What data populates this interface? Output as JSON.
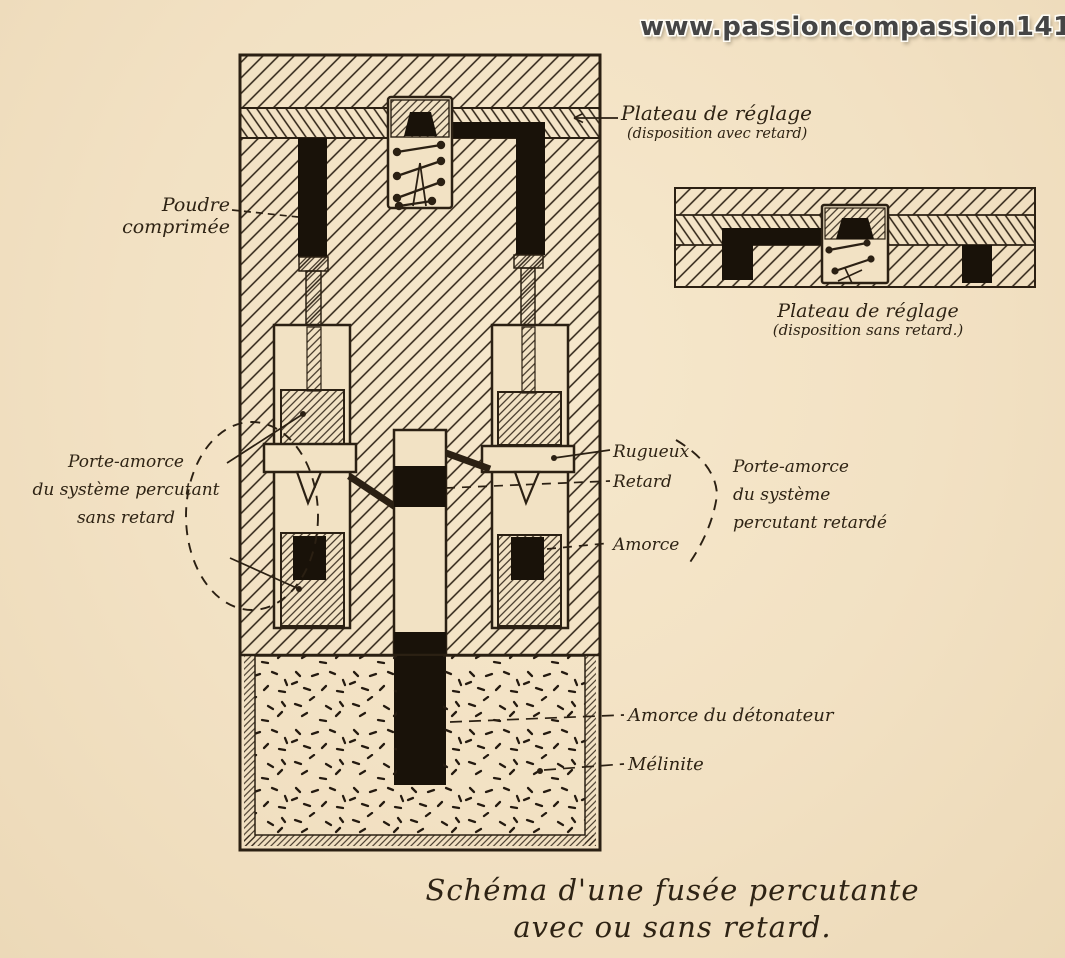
{
  "watermark": "www.passioncompassion1418.com",
  "colors": {
    "paper": "#f2e2c4",
    "ink": "#2b2013",
    "fill_black": "#191209",
    "watermark_text": "#454545"
  },
  "labels": {
    "plateau_avec": {
      "line1": "Plateau de réglage",
      "line2": "(disposition avec retard)"
    },
    "poudre": {
      "line1": "Poudre",
      "line2": "comprimée"
    },
    "porte_amorce_sans": {
      "line1": "Porte-amorce",
      "line2": "du système percutant",
      "line3": "sans retard"
    },
    "rugueux": "Rugueux",
    "retard": "Retard",
    "amorce": "Amorce",
    "porte_amorce_retarde": {
      "line1": "Porte-amorce",
      "line2": "du système",
      "line3": "percutant retardé"
    },
    "amorce_detonateur": "Amorce du détonateur",
    "melinite": "Mélinite",
    "plateau_sans": {
      "line1": "Plateau de réglage",
      "line2": "(disposition sans retard.)"
    }
  },
  "caption": {
    "line1": "Schéma d'une fusée percutante",
    "line2": "avec ou sans retard."
  }
}
